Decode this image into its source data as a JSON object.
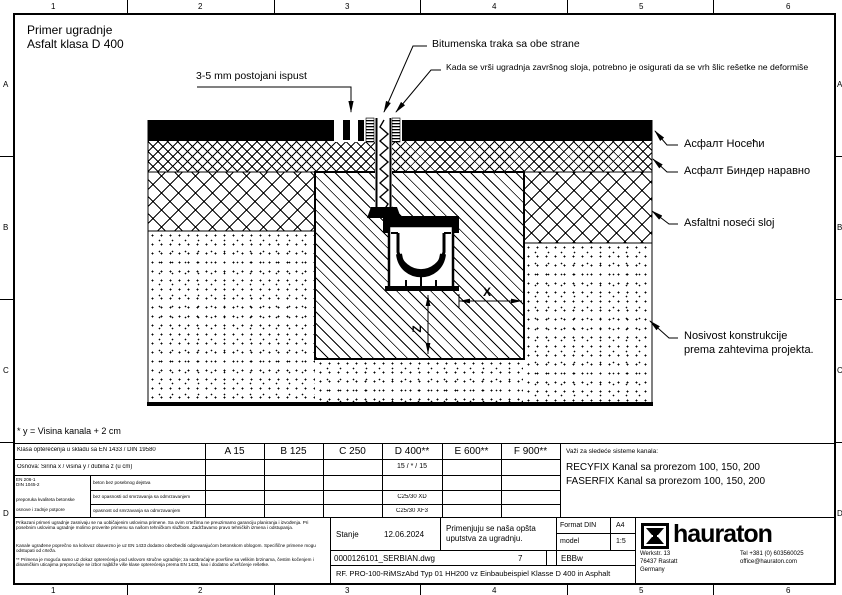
{
  "grid": {
    "cols": [
      "1",
      "2",
      "3",
      "4",
      "5",
      "6"
    ],
    "rows": [
      "A",
      "B",
      "C",
      "D"
    ]
  },
  "title": {
    "line1": "Primer ugradnje",
    "line2": "Asfalt klasa D 400"
  },
  "callouts": {
    "ispust": "3-5 mm postojani ispust",
    "bitumen": "Bitumenska traka sa obe strane",
    "kada": "Kada se vrši ugradnja završnog sloja, potrebno je osigurati da se vrh šlic rešetke ne deformiše",
    "asfalt_noseci": "Асфалт Носећи",
    "asfalt_binder": "Асфалт Биндер наравно",
    "asfaltni_sloj": "Asfaltni noseći sloj",
    "nosivost_1": "Nosivost konstrukcije",
    "nosivost_2": "prema zahtevima projekta."
  },
  "dims": {
    "x": "X",
    "z": "Z"
  },
  "footnote": "* y = Visina kanala + 2 cm",
  "class_table": {
    "header_label": "Klasa opterećenja u skladu sa EN 1433 / DIN 19580",
    "classes": [
      "A 15",
      "B 125",
      "C 250",
      "D 400**",
      "E 600**",
      "F 900**"
    ],
    "row2_label": "Osnova: Širina x / visina y / dubina z (u cm)",
    "row2_d400": "15 / * / 15",
    "concrete_code_1": "EN 206-1",
    "concrete_code_2": "DIN 1045-2",
    "concrete_note_1": "preporuka kvaliteta betonske",
    "concrete_note_2": "osnove i zadnje potpore",
    "sub_rows": [
      "beton bez posebnog dejstva",
      "bez opasnosti od smrzavanja sa odmrzavanjem",
      "opasnost od smrzavanja sa odmrzavanjem"
    ],
    "sub_values_d400": [
      "C25/30 XD",
      "C25/30 XF3"
    ]
  },
  "systems": {
    "heading": "Važi za sledeće sisteme kanala:",
    "items": [
      "RECYFIX Kanal sa prorezom 100, 150, 200",
      "FASERFIX Kanal sa prorezom 100, 150, 200"
    ]
  },
  "titleblock": {
    "disclaimer1": "Prikazani primeri ugradnje zasnivaju se na uobičajenim uslovima primene. Sa ovim crtežima ne preuzimamo garanciju planiranja i izvođenja. Pri posebnim uslovima ugradnje molimo proverite primenu sa našom tehničkom službom. Zadržavamo pravo tehničkih izmena i odstupanja.",
    "disclaimer2": "Kanale ugrađene poprečno na kolovoz obavezno je uz EN 1433 dodatno obezbediti odgovarajućom betonskom oblogom. Specifične primene mogu odstupati od crteža.",
    "disclaimer3": "** Primena je moguća samo uz dokaz opterećenja pod uslovom stručne ugradnje; za saobraćajne površine sa velikim brzinama, čestim kočenjem i dinamičkim uticajima preporučuje se izbor najbliže više klase opterećenja prema EN 1433, kao i dodatno učvršćenje rešetke.",
    "stanje_label": "Stanje",
    "stanje_date": "12.06.2024",
    "note_line1": "Primenjuju se naša opšta",
    "note_line2": "uputstva za ugradnju.",
    "format_label": "Format DIN",
    "format_value": "A4",
    "model_label": "model",
    "model_value": "1:5",
    "file_name": "0000126101_SERBIAN.dwg",
    "sheet_no": "7",
    "code": "EBBw",
    "drawing_name": "RF. PRO-100-RiMSzAbd Typ 01 HH200 vz Einbaubeispiel Klasse D 400 in Asphalt",
    "brand": "hauraton",
    "address1": "Werkstr. 13",
    "address2": "76437 Rastatt",
    "address3": "Germany",
    "phone": "Tel +381 (0) 603560025",
    "email": "office@hauraton.com"
  }
}
